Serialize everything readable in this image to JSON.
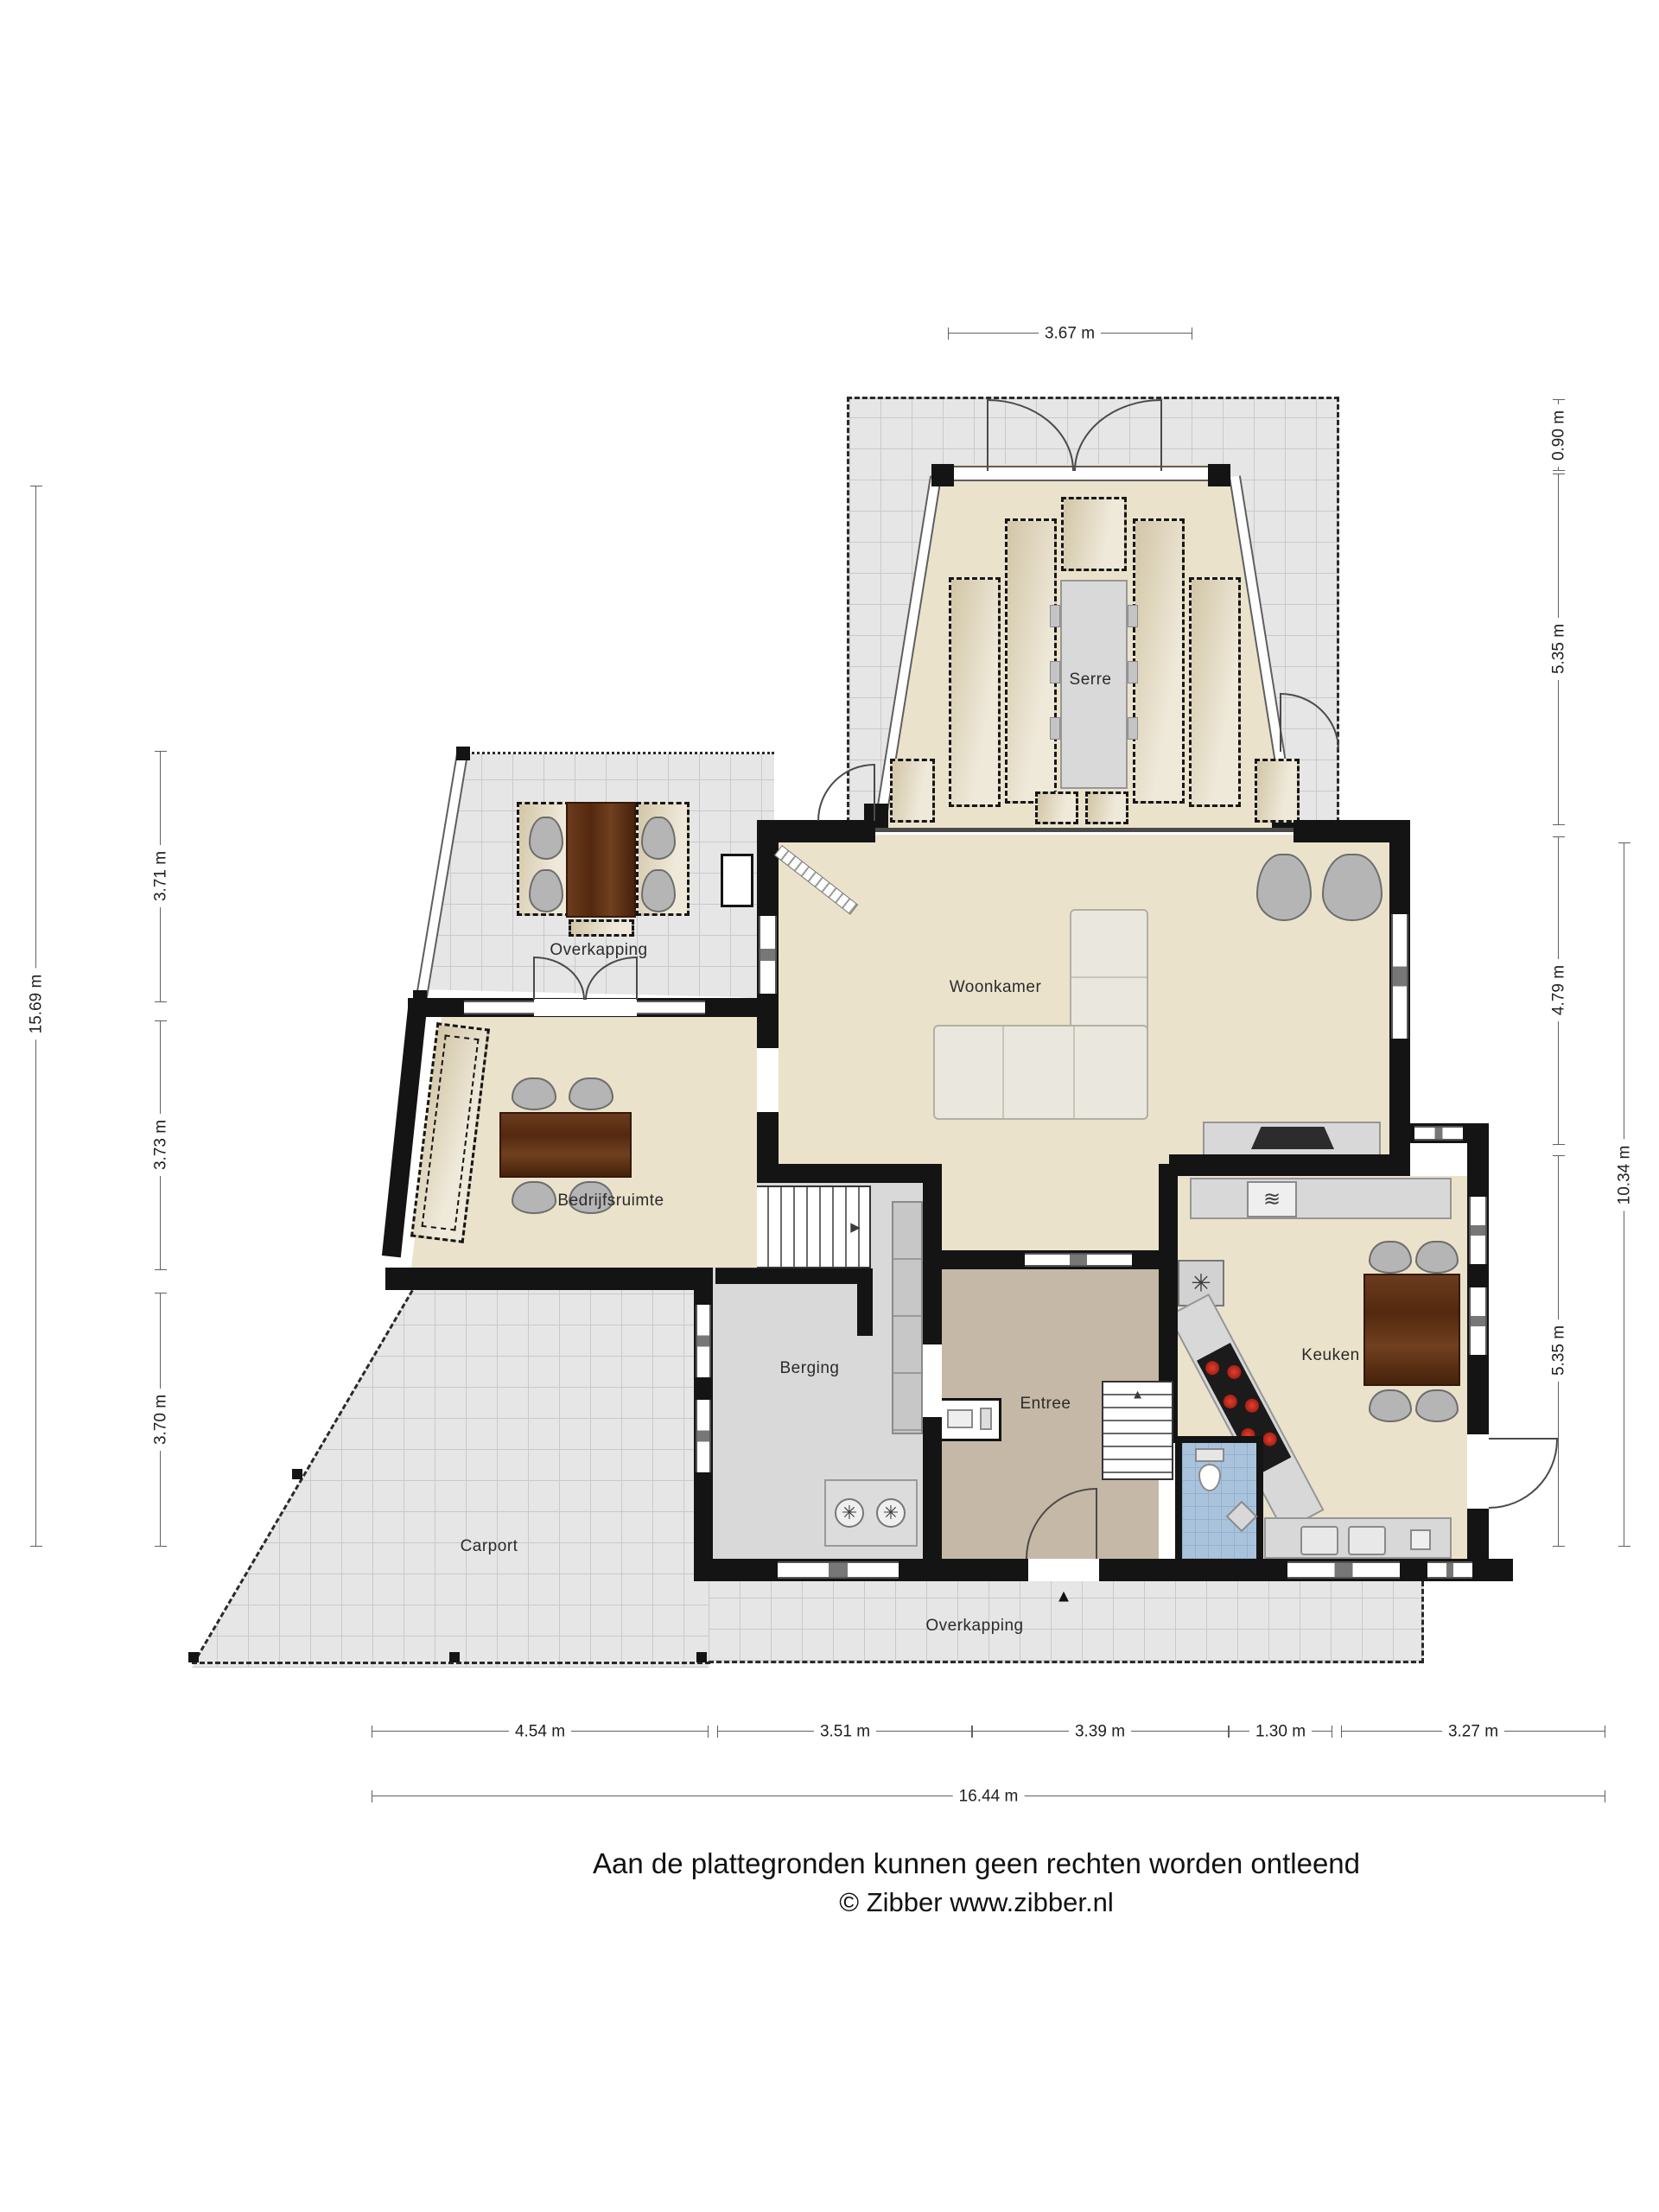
{
  "rooms": {
    "serre": "Serre",
    "woonkamer": "Woonkamer",
    "overkapping_boven": "Overkapping",
    "bedrijfsruimte": "Bedrijfsruimte",
    "berging": "Berging",
    "entree": "Entree",
    "keuken": "Keuken",
    "carport": "Carport",
    "overkapping_onder": "Overkapping"
  },
  "dims": {
    "top": "3.67 m",
    "left_outer": "15.69 m",
    "left_inner": [
      "3.71 m",
      "3.73 m",
      "3.70 m"
    ],
    "right_inner": [
      "0.90 m",
      "5.35 m",
      "4.79 m",
      "5.35 m"
    ],
    "right_outer": "10.34 m",
    "bottom": [
      "4.54 m",
      "3.51 m",
      "3.39 m",
      "1.30 m",
      "3.27 m"
    ],
    "bottom_total": "16.44 m"
  },
  "icons": {
    "washer": "✳",
    "fridge": "✳",
    "oven": "≋",
    "stairs_up": "▲",
    "stairs_right": "▶",
    "entrance": "▲"
  },
  "colors": {
    "wall": "#141414",
    "floor_beige": "#ebe2cb",
    "terrace_gray": "#e6e6e6",
    "entree_taupe": "#c6b8a6",
    "berging_gray": "#d9d9d9",
    "wc_blue": "#aac3dd",
    "wood_brown": "#5d2f12",
    "burner_red": "#c02a1e"
  },
  "footer": {
    "disclaimer": "Aan de plattegronden kunnen geen rechten worden ontleend",
    "copyright": "© Zibber www.zibber.nl"
  }
}
